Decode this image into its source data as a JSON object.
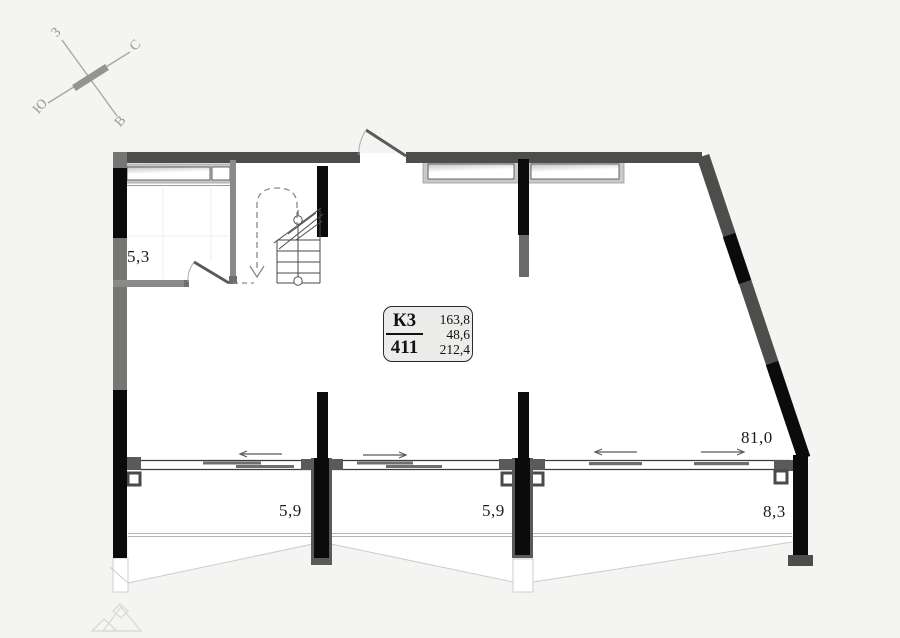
{
  "compass": {
    "west": "З",
    "north": "С",
    "south": "Ю",
    "east": "В"
  },
  "unit_card": {
    "block_label": "К3",
    "unit_number": "411",
    "area_values": [
      "163,8",
      "48,6",
      "212,4"
    ]
  },
  "dimensions": {
    "room_small": "5,3",
    "balcony_left": "5,9",
    "balcony_mid": "5,9",
    "balcony_right": "8,3",
    "terrace": "81,0"
  },
  "colors": {
    "background": "#f4f4f2",
    "wall_dark": "#4d4d4d",
    "column_black": "#0b0b0b",
    "partition_gray": "#8a8a8a",
    "faint_line": "#cccccc",
    "card_fill": "#ececea",
    "text": "#1c1c1c"
  }
}
